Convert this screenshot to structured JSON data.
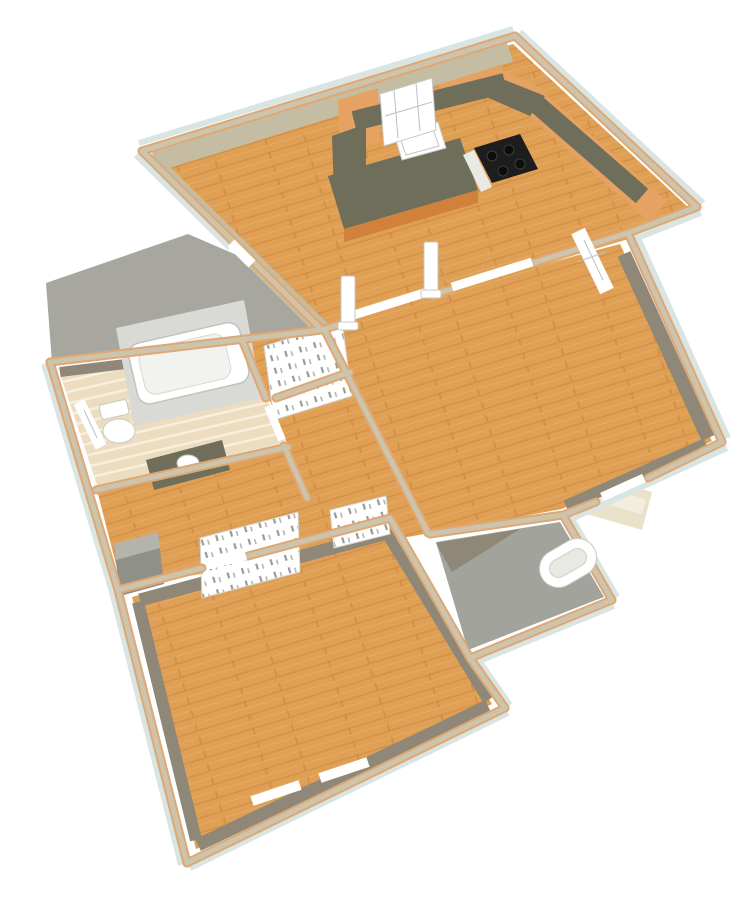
{
  "scene": {
    "description": "3D overhead dollhouse rendering of a single-story house floor plan on a white background, rotated with the kitchen wing at top",
    "rooms": [
      {
        "name": "kitchen",
        "floor": "wood",
        "location": "top wing, right"
      },
      {
        "name": "dining-area",
        "floor": "wood",
        "location": "top wing, left"
      },
      {
        "name": "living-room",
        "floor": "wood",
        "location": "center right"
      },
      {
        "name": "hallway",
        "floor": "wood",
        "location": "center"
      },
      {
        "name": "bathroom",
        "floor": "tile",
        "location": "center left"
      },
      {
        "name": "bedroom",
        "floor": "wood",
        "location": "bottom"
      },
      {
        "name": "porch",
        "floor": "concrete",
        "location": "bottom right"
      },
      {
        "name": "patio",
        "floor": "concrete",
        "location": "outside upper left"
      }
    ],
    "fixtures": [
      "kitchen-cabinets",
      "kitchen-countertop",
      "kitchen-sink",
      "stove",
      "kitchen-window",
      "bathtub",
      "toilet",
      "vanity-sink",
      "bathroom-window",
      "entry-columns",
      "door-headers",
      "linen-closet-shelves",
      "hall-closet-shelves",
      "living-room-window",
      "bedroom-windows",
      "porch-oval-opening",
      "exterior-steps",
      "utility-pad",
      "door-thresholds"
    ]
  },
  "colors": {
    "background": "#ffffff",
    "wood": "#dfa055",
    "wood_dark": "#c9873d",
    "wood_light": "#ecb56e",
    "walltop": "#cdc4ad",
    "trim": "#dfa772",
    "ext_band": "#d9e5e3",
    "wallface_light": "#c5bca4",
    "wallface_dark": "#8f8878",
    "concrete": "#a7a7a0",
    "porch_floor": "#a2a39c",
    "steps": "#e9e1ca",
    "steps_top": "#f3eddd",
    "counter": "#6e6e5a",
    "cabinet": "#e5a263",
    "cabinet_dark": "#d2813d",
    "tile": "#ecdcc0",
    "tile_line": "#f8efdc",
    "fixture_white": "#ffffff",
    "stove_black": "#1d1d1d"
  }
}
